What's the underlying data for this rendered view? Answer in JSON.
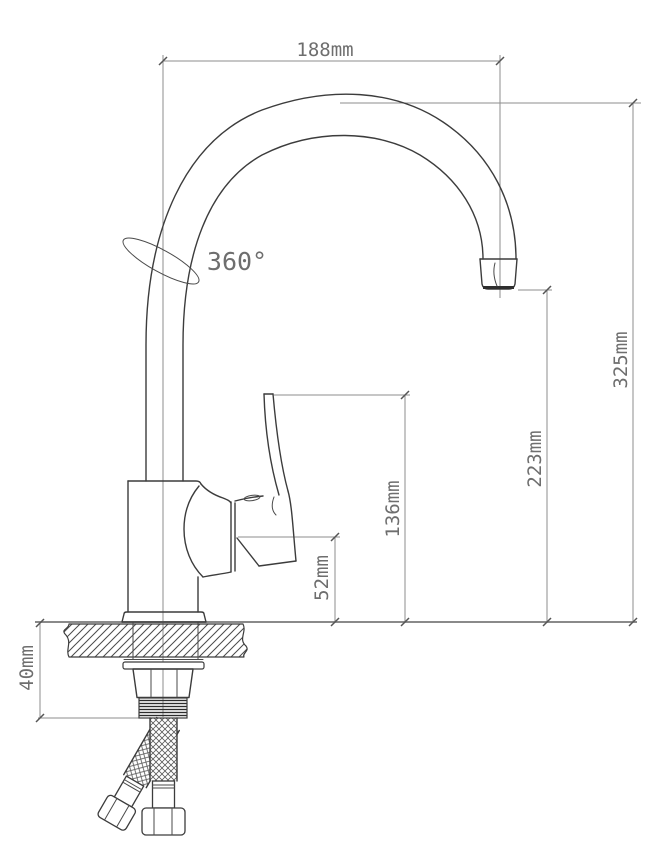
{
  "drawing": {
    "labels": {
      "spout_reach": "188mm",
      "swivel_angle": "360°",
      "total_height": "325mm",
      "spout_height": "223mm",
      "handle_height": "136mm",
      "body_height": "52mm",
      "mounting_depth": "40mm"
    },
    "colors": {
      "outline": "#3c3c3c",
      "dimension_lines": "#8d8d8d",
      "label_text": "#6e6e6e",
      "background": "#ffffff"
    }
  }
}
